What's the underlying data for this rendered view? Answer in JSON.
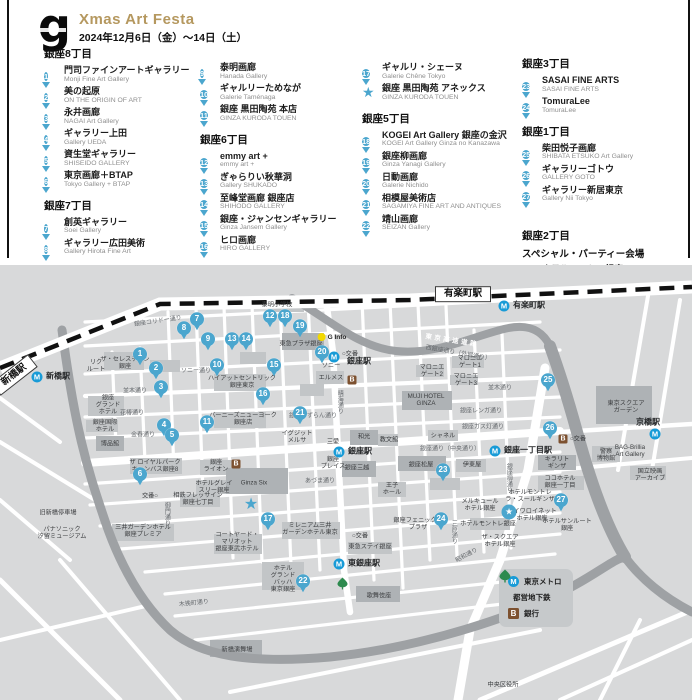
{
  "header": {
    "logo_letter": "g",
    "title": "Xmas Art Festa",
    "dates": "2024年12月6日（金）～14日（土）"
  },
  "colors": {
    "accent_gold": "#b5985f",
    "pin_blue": "#4ba6ce",
    "metro_blue": "#189bd7",
    "toei_green": "#2d8a4e",
    "bank_brown": "#7d5130",
    "ginfo_yellow": "#f2d800"
  },
  "directory": {
    "columns": [
      {
        "x": 44,
        "pad_top": 0,
        "blocks": [
          {
            "heading": "銀座8丁目",
            "items": [
              {
                "marker": "pin",
                "num": "1",
                "ja": "門司ファインアートギャラリー",
                "en": "Monji Fine Art Gallery"
              },
              {
                "marker": "pin",
                "num": "2",
                "ja": "美の起原",
                "en": "ON THE ORIGIN OF ART"
              },
              {
                "marker": "pin",
                "num": "3",
                "ja": "永井画廊",
                "en": "NAGAI Art Gallery"
              },
              {
                "marker": "pin",
                "num": "4",
                "ja": "ギャラリー上田",
                "en": "Gallery UEDA"
              },
              {
                "marker": "pin",
                "num": "5",
                "ja": "資生堂ギャラリー",
                "en": "SHISEIDO GALLERY"
              },
              {
                "marker": "pin",
                "num": "6",
                "ja": "東京画廊＋BTAP",
                "en": "Tokyo Gallery + BTAP"
              }
            ]
          },
          {
            "heading": "銀座7丁目",
            "items": [
              {
                "marker": "pin",
                "num": "7",
                "ja": "創英ギャラリー",
                "en": "Soei Gallery"
              },
              {
                "marker": "pin",
                "num": "8",
                "ja": "ギャラリー広田美術",
                "en": "Gallery Hirota Fine Art"
              }
            ]
          }
        ]
      },
      {
        "x": 200,
        "pad_top": 17,
        "blocks": [
          {
            "items": [
              {
                "marker": "pin",
                "num": "9",
                "ja": "泰明画廊",
                "en": "Hanada Gallery"
              },
              {
                "marker": "pin",
                "num": "10",
                "ja": "ギャルリーためなが",
                "en": "Galerie Taménaga"
              },
              {
                "marker": "pin",
                "num": "11",
                "ja": "銀座 黒田陶苑 本店",
                "en": "GINZA KURODA TOUEN"
              }
            ]
          },
          {
            "heading": "銀座6丁目",
            "items": [
              {
                "marker": "pin",
                "num": "12",
                "ja": "emmy art +",
                "en": "emmy art +"
              },
              {
                "marker": "pin",
                "num": "13",
                "ja": "ぎゃらりい秋華洞",
                "en": "Gallery SHUKADO"
              },
              {
                "marker": "pin",
                "num": "14",
                "ja": "至峰堂画廊 銀座店",
                "en": "SHIHODO GALLERY"
              },
              {
                "marker": "pin",
                "num": "15",
                "ja": "銀座・ジャンセンギャラリー",
                "en": "Ginza Jansem Gallery"
              },
              {
                "marker": "pin",
                "num": "16",
                "ja": "ヒロ画廊",
                "en": "HIRO GALLERY"
              }
            ]
          }
        ]
      },
      {
        "x": 362,
        "pad_top": 17,
        "blocks": [
          {
            "items": [
              {
                "marker": "pin",
                "num": "17",
                "ja": "ギャルリ・シェーヌ",
                "en": "Galerie Chêne Tokyo"
              },
              {
                "marker": "star",
                "ja": "銀座 黒田陶苑 アネックス",
                "en": "GINZA KURODA TOUEN"
              }
            ]
          },
          {
            "heading": "銀座5丁目",
            "items": [
              {
                "marker": "pin",
                "num": "18",
                "ja": "KOGEI Art Gallery 銀座の金沢",
                "en": "KOGEI Art Gallery Ginza no Kanazawa"
              },
              {
                "marker": "pin",
                "num": "19",
                "ja": "銀座柳画廊",
                "en": "Ginza Yanagi Gallery"
              },
              {
                "marker": "pin",
                "num": "20",
                "ja": "日動画廊",
                "en": "Galerie Nichido"
              },
              {
                "marker": "pin",
                "num": "21",
                "ja": "相模屋美術店",
                "en": "SAGAMIYA FINE ART AND ANTIQUES"
              },
              {
                "marker": "pin",
                "num": "22",
                "ja": "靖山画廊",
                "en": "SEIZAN Gallery"
              }
            ]
          }
        ]
      },
      {
        "x": 522,
        "pad_top": 0,
        "blocks": [
          {
            "heading": "銀座3丁目",
            "items": [
              {
                "marker": "pin",
                "num": "23",
                "ja": "SASAI FINE ARTS",
                "en": "SASAI FINE ARTS"
              },
              {
                "marker": "pin",
                "num": "24",
                "ja": "TomuraLee",
                "en": "TomuraLee"
              }
            ]
          },
          {
            "heading": "銀座1丁目",
            "items": [
              {
                "marker": "pin",
                "num": "25",
                "ja": "柴田悦子画廊",
                "en": "SHIBATA ETSUKO Art Gallery"
              },
              {
                "marker": "pin",
                "num": "26",
                "ja": "ギャラリーゴトウ",
                "en": "GALLERY GOTO"
              },
              {
                "marker": "pin",
                "num": "27",
                "ja": "ギャラリー新居東京",
                "en": "Gallery Nii Tokyo"
              }
            ]
          },
          {
            "heading": "銀座2丁目",
            "gap_before": 16,
            "subheading": "スペシャル・パーティー会場",
            "items": [
              {
                "marker": "circlestar",
                "ja": "ホテルモントレ銀座",
                "en": "HOTEL MONTEREY GINZA"
              }
            ]
          }
        ]
      }
    ]
  },
  "map": {
    "legend": {
      "metro": "東京メトロ",
      "toei": "都営地下鉄",
      "bank": "銀行"
    },
    "jr_boxes": [
      {
        "t": "有楽町駅",
        "x": 463,
        "y": 294,
        "r": 0
      },
      {
        "t": "新橋駅",
        "x": 14,
        "y": 375,
        "r": -38
      }
    ],
    "stations": [
      {
        "icon": "metro",
        "x": 37,
        "y": 377,
        "label": "新橋駅"
      },
      {
        "icon": "metro",
        "x": 504,
        "y": 306,
        "label": "有楽町駅"
      },
      {
        "icon": "metro",
        "x": 334,
        "y": 357,
        "label": ""
      },
      {
        "icon": "metro",
        "x": 339,
        "y": 452,
        "label": "銀座駅"
      },
      {
        "icon": "metro",
        "x": 495,
        "y": 451,
        "label": "銀座一丁目駅"
      },
      {
        "icon": "metro",
        "x": 339,
        "y": 564,
        "label": "東銀座駅"
      },
      {
        "icon": "toei",
        "x": 337,
        "y": 577,
        "label": ""
      },
      {
        "icon": "metro",
        "x": 655,
        "y": 434,
        "label": ""
      }
    ],
    "bank_icons": [
      {
        "x": 352,
        "y": 380
      },
      {
        "x": 236,
        "y": 464
      },
      {
        "x": 563,
        "y": 439
      }
    ],
    "ginfo": {
      "x": 322,
      "y": 337,
      "label": "G Info"
    },
    "pins": [
      {
        "n": "1",
        "x": 140,
        "y": 357
      },
      {
        "n": "2",
        "x": 156,
        "y": 371
      },
      {
        "n": "3",
        "x": 161,
        "y": 390
      },
      {
        "n": "4",
        "x": 164,
        "y": 428
      },
      {
        "n": "5",
        "x": 172,
        "y": 438
      },
      {
        "n": "6",
        "x": 140,
        "y": 477
      },
      {
        "n": "7",
        "x": 197,
        "y": 322
      },
      {
        "n": "8",
        "x": 184,
        "y": 331
      },
      {
        "n": "9",
        "x": 208,
        "y": 342
      },
      {
        "n": "10",
        "x": 217,
        "y": 368
      },
      {
        "n": "11",
        "x": 207,
        "y": 425
      },
      {
        "n": "12",
        "x": 270,
        "y": 319
      },
      {
        "n": "13",
        "x": 232,
        "y": 342
      },
      {
        "n": "14",
        "x": 246,
        "y": 342
      },
      {
        "n": "15",
        "x": 274,
        "y": 368
      },
      {
        "n": "16",
        "x": 263,
        "y": 397
      },
      {
        "n": "17",
        "x": 268,
        "y": 522
      },
      {
        "n": "18",
        "x": 285,
        "y": 319
      },
      {
        "n": "19",
        "x": 300,
        "y": 329
      },
      {
        "n": "20",
        "x": 322,
        "y": 355
      },
      {
        "n": "21",
        "x": 300,
        "y": 416
      },
      {
        "n": "22",
        "x": 303,
        "y": 584
      },
      {
        "n": "23",
        "x": 443,
        "y": 473
      },
      {
        "n": "24",
        "x": 441,
        "y": 522
      },
      {
        "n": "25",
        "x": 548,
        "y": 383
      },
      {
        "n": "26",
        "x": 550,
        "y": 431
      },
      {
        "n": "27",
        "x": 561,
        "y": 503
      }
    ],
    "stars": [
      {
        "kind": "plain",
        "x": 251,
        "y": 505
      },
      {
        "kind": "circle",
        "x": 509,
        "y": 512
      }
    ],
    "labels": [
      {
        "t": "泰明小学校",
        "x": 277,
        "y": 306,
        "c": "bldg"
      },
      {
        "t": "東急プラザ銀座",
        "x": 301,
        "y": 345,
        "c": "bldg"
      },
      {
        "t": "ソニー",
        "x": 331,
        "y": 367,
        "c": "bldg"
      },
      {
        "t": "エルメス",
        "x": 331,
        "y": 379,
        "c": "bldg"
      },
      {
        "l": [
          "リク",
          "ルート"
        ],
        "x": 96,
        "y": 367,
        "c": "bldg"
      },
      {
        "l": [
          "ザ・セレスティン",
          "銀座"
        ],
        "x": 125,
        "y": 364,
        "c": "bldg"
      },
      {
        "l": [
          "銀座",
          "グランド",
          "ホテル"
        ],
        "x": 108,
        "y": 406,
        "c": "bldg"
      },
      {
        "l": [
          "銀座国際",
          "ホテル"
        ],
        "x": 105,
        "y": 427,
        "c": "bldg"
      },
      {
        "t": "博品館",
        "x": 110,
        "y": 445,
        "c": "bldg"
      },
      {
        "l": [
          "ハイアットセントリック",
          "銀座東京"
        ],
        "x": 242,
        "y": 383,
        "c": "bldg"
      },
      {
        "l": [
          "バーニーズニューヨーク",
          "銀座店"
        ],
        "x": 243,
        "y": 420,
        "c": "bldg"
      },
      {
        "l": [
          "イグジット",
          "メルサ"
        ],
        "x": 297,
        "y": 438,
        "c": "bldg"
      },
      {
        "t": "三愛",
        "x": 333,
        "y": 443,
        "c": "bldg"
      },
      {
        "t": "和光",
        "x": 364,
        "y": 438,
        "c": "bldg"
      },
      {
        "t": "教文館",
        "x": 389,
        "y": 441,
        "c": "bldg"
      },
      {
        "t": "シャネル",
        "x": 443,
        "y": 437,
        "c": "bldg"
      },
      {
        "l": [
          "MUJI HOTEL",
          "GINZA"
        ],
        "x": 426,
        "y": 401,
        "c": "bldg"
      },
      {
        "l": [
          "マロニエ",
          "ゲート1"
        ],
        "x": 470,
        "y": 363,
        "c": "bldg"
      },
      {
        "l": [
          "マロニエ",
          "ゲート2"
        ],
        "x": 432,
        "y": 372,
        "c": "bldg"
      },
      {
        "l": [
          "マロニエ",
          "ゲート3"
        ],
        "x": 466,
        "y": 381,
        "c": "bldg"
      },
      {
        "l": [
          "銀座",
          "プレイス"
        ],
        "x": 333,
        "y": 464,
        "c": "bldg"
      },
      {
        "t": "銀座三越",
        "x": 357,
        "y": 469,
        "c": "bldg"
      },
      {
        "t": "銀座松屋",
        "x": 421,
        "y": 466,
        "c": "bldg"
      },
      {
        "t": "伊東屋",
        "x": 472,
        "y": 466,
        "c": "bldg"
      },
      {
        "l": [
          "王子",
          "ホール"
        ],
        "x": 392,
        "y": 490,
        "c": "bldg"
      },
      {
        "l": [
          "銀座",
          "ライオン"
        ],
        "x": 216,
        "y": 467,
        "c": "bldg"
      },
      {
        "l": [
          "ザ ロイヤルパーク",
          "キャンバス銀座8"
        ],
        "x": 155,
        "y": 467,
        "c": "bldg"
      },
      {
        "t": "Ginza Six",
        "x": 254,
        "y": 484,
        "c": "bldg"
      },
      {
        "l": [
          "ホテルグレイ",
          "スリー銀座"
        ],
        "x": 214,
        "y": 488,
        "c": "bldg"
      },
      {
        "l": [
          "相鉄フレッサイン",
          "銀座七丁目"
        ],
        "x": 198,
        "y": 500,
        "c": "bldg"
      },
      {
        "t": "交番○",
        "x": 150,
        "y": 497,
        "c": "bldg"
      },
      {
        "l": [
          "三井ガーデンホテル",
          "銀座プレミア"
        ],
        "x": 143,
        "y": 532,
        "c": "bldg"
      },
      {
        "l": [
          "パナソニック",
          "汐留ミュージアム"
        ],
        "x": 62,
        "y": 534,
        "c": "bldg"
      },
      {
        "t": "旧新橋停車場",
        "x": 58,
        "y": 514,
        "c": "bldg"
      },
      {
        "l": [
          "コートヤード・",
          "マリオット",
          "銀座東武ホテル"
        ],
        "x": 237,
        "y": 543,
        "c": "bldg"
      },
      {
        "l": [
          "ミレニアム三井",
          "ガーデンホテル東京"
        ],
        "x": 310,
        "y": 530,
        "c": "bldg"
      },
      {
        "t": "○交番",
        "x": 360,
        "y": 537,
        "c": "bldg"
      },
      {
        "t": "東急ステイ銀座",
        "x": 370,
        "y": 548,
        "c": "bldg"
      },
      {
        "l": [
          "ホテル",
          "グランド",
          "バッハ",
          "東京銀座"
        ],
        "x": 283,
        "y": 580,
        "c": "bldg"
      },
      {
        "t": "歌舞伎座",
        "x": 379,
        "y": 597,
        "c": "bldg"
      },
      {
        "t": "新橋演舞場",
        "x": 237,
        "y": 651,
        "c": "bldg"
      },
      {
        "l": [
          "キラリト",
          "ギンザ"
        ],
        "x": 557,
        "y": 464,
        "c": "bldg"
      },
      {
        "l": [
          "ココホテル",
          "銀座一丁目"
        ],
        "x": 560,
        "y": 483,
        "c": "bldg"
      },
      {
        "l": [
          "ホテルモントレ",
          "ラ・スールギンザ"
        ],
        "x": 530,
        "y": 497,
        "c": "bldg"
      },
      {
        "l": [
          "メルキュール",
          "ホテル銀座"
        ],
        "x": 480,
        "y": 506,
        "c": "bldg"
      },
      {
        "l": [
          "ダイワロイネット",
          "ホテル銀座"
        ],
        "x": 532,
        "y": 516,
        "c": "bldg"
      },
      {
        "t": "ホテルモントレ銀座",
        "x": 488,
        "y": 525,
        "c": "bldg"
      },
      {
        "l": [
          "ホテルサンルート",
          "銀座"
        ],
        "x": 567,
        "y": 526,
        "c": "bldg"
      },
      {
        "l": [
          "ザ・スクエア",
          "ホテル銀座"
        ],
        "x": 500,
        "y": 542,
        "c": "bldg"
      },
      {
        "l": [
          "銀座フェニックス",
          "プラザ"
        ],
        "x": 418,
        "y": 525,
        "c": "bldg"
      },
      {
        "l": [
          "東京スクエア",
          "ガーデン"
        ],
        "x": 626,
        "y": 408,
        "c": "bldg"
      },
      {
        "t": "○交番",
        "x": 578,
        "y": 440,
        "c": "bldg"
      },
      {
        "l": [
          "BAG-Brillia",
          "Art Gallery"
        ],
        "x": 630,
        "y": 452,
        "c": "bldg"
      },
      {
        "l": [
          "警察",
          "博物館"
        ],
        "x": 606,
        "y": 456,
        "c": "bldg"
      },
      {
        "l": [
          "国立映画",
          "アーカイブ"
        ],
        "x": 650,
        "y": 476,
        "c": "bldg"
      },
      {
        "t": "中央区役所",
        "x": 503,
        "y": 686,
        "c": "bldg"
      },
      {
        "t": "京橋駅",
        "x": 648,
        "y": 423,
        "c": "station2"
      },
      {
        "t": "○交番",
        "x": 350,
        "y": 355,
        "c": "bldg"
      },
      {
        "t": "銀座駅",
        "x": 359,
        "y": 362,
        "c": "station2"
      },
      {
        "t": "銀座コリドー通り",
        "x": 158,
        "y": 322,
        "c": "street",
        "r": -8
      },
      {
        "t": "ソニー通り",
        "x": 196,
        "y": 372,
        "c": "street"
      },
      {
        "t": "並木通り",
        "x": 135,
        "y": 392,
        "c": "street"
      },
      {
        "t": "花椿通り",
        "x": 132,
        "y": 414,
        "c": "street"
      },
      {
        "t": "金春通り",
        "x": 143,
        "y": 436,
        "c": "street"
      },
      {
        "t": "並木通り",
        "x": 500,
        "y": 389,
        "c": "street"
      },
      {
        "t": "銀座レンガ通り",
        "x": 481,
        "y": 412,
        "c": "street"
      },
      {
        "t": "銀座ガス灯通り",
        "x": 483,
        "y": 428,
        "c": "street"
      },
      {
        "t": "銀座通り（中央通り）",
        "x": 450,
        "y": 450,
        "c": "street"
      },
      {
        "t": "西銀座通り（外堀通り）",
        "x": 458,
        "y": 354,
        "c": "street",
        "r": 10
      },
      {
        "t": "銀座すずらん通り",
        "x": 313,
        "y": 417,
        "c": "street"
      },
      {
        "t": "あづま通り",
        "x": 320,
        "y": 482,
        "c": "street"
      },
      {
        "t": "木挽町通り",
        "x": 194,
        "y": 604,
        "c": "street",
        "r": -6
      },
      {
        "t": "昭和通り",
        "x": 467,
        "y": 556,
        "c": "street",
        "r": -28
      },
      {
        "t": "晴海通り",
        "x": 339,
        "y": 402,
        "c": "street vert"
      },
      {
        "t": "三原通り",
        "x": 453,
        "y": 532,
        "c": "street vert"
      },
      {
        "t": "銀座柳通り",
        "x": 508,
        "y": 478,
        "c": "street vert"
      },
      {
        "t": "御門通り",
        "x": 166,
        "y": 514,
        "c": "street vert"
      },
      {
        "t": "東京高速道路",
        "x": 452,
        "y": 341,
        "c": "hwy",
        "r": 9
      }
    ]
  }
}
